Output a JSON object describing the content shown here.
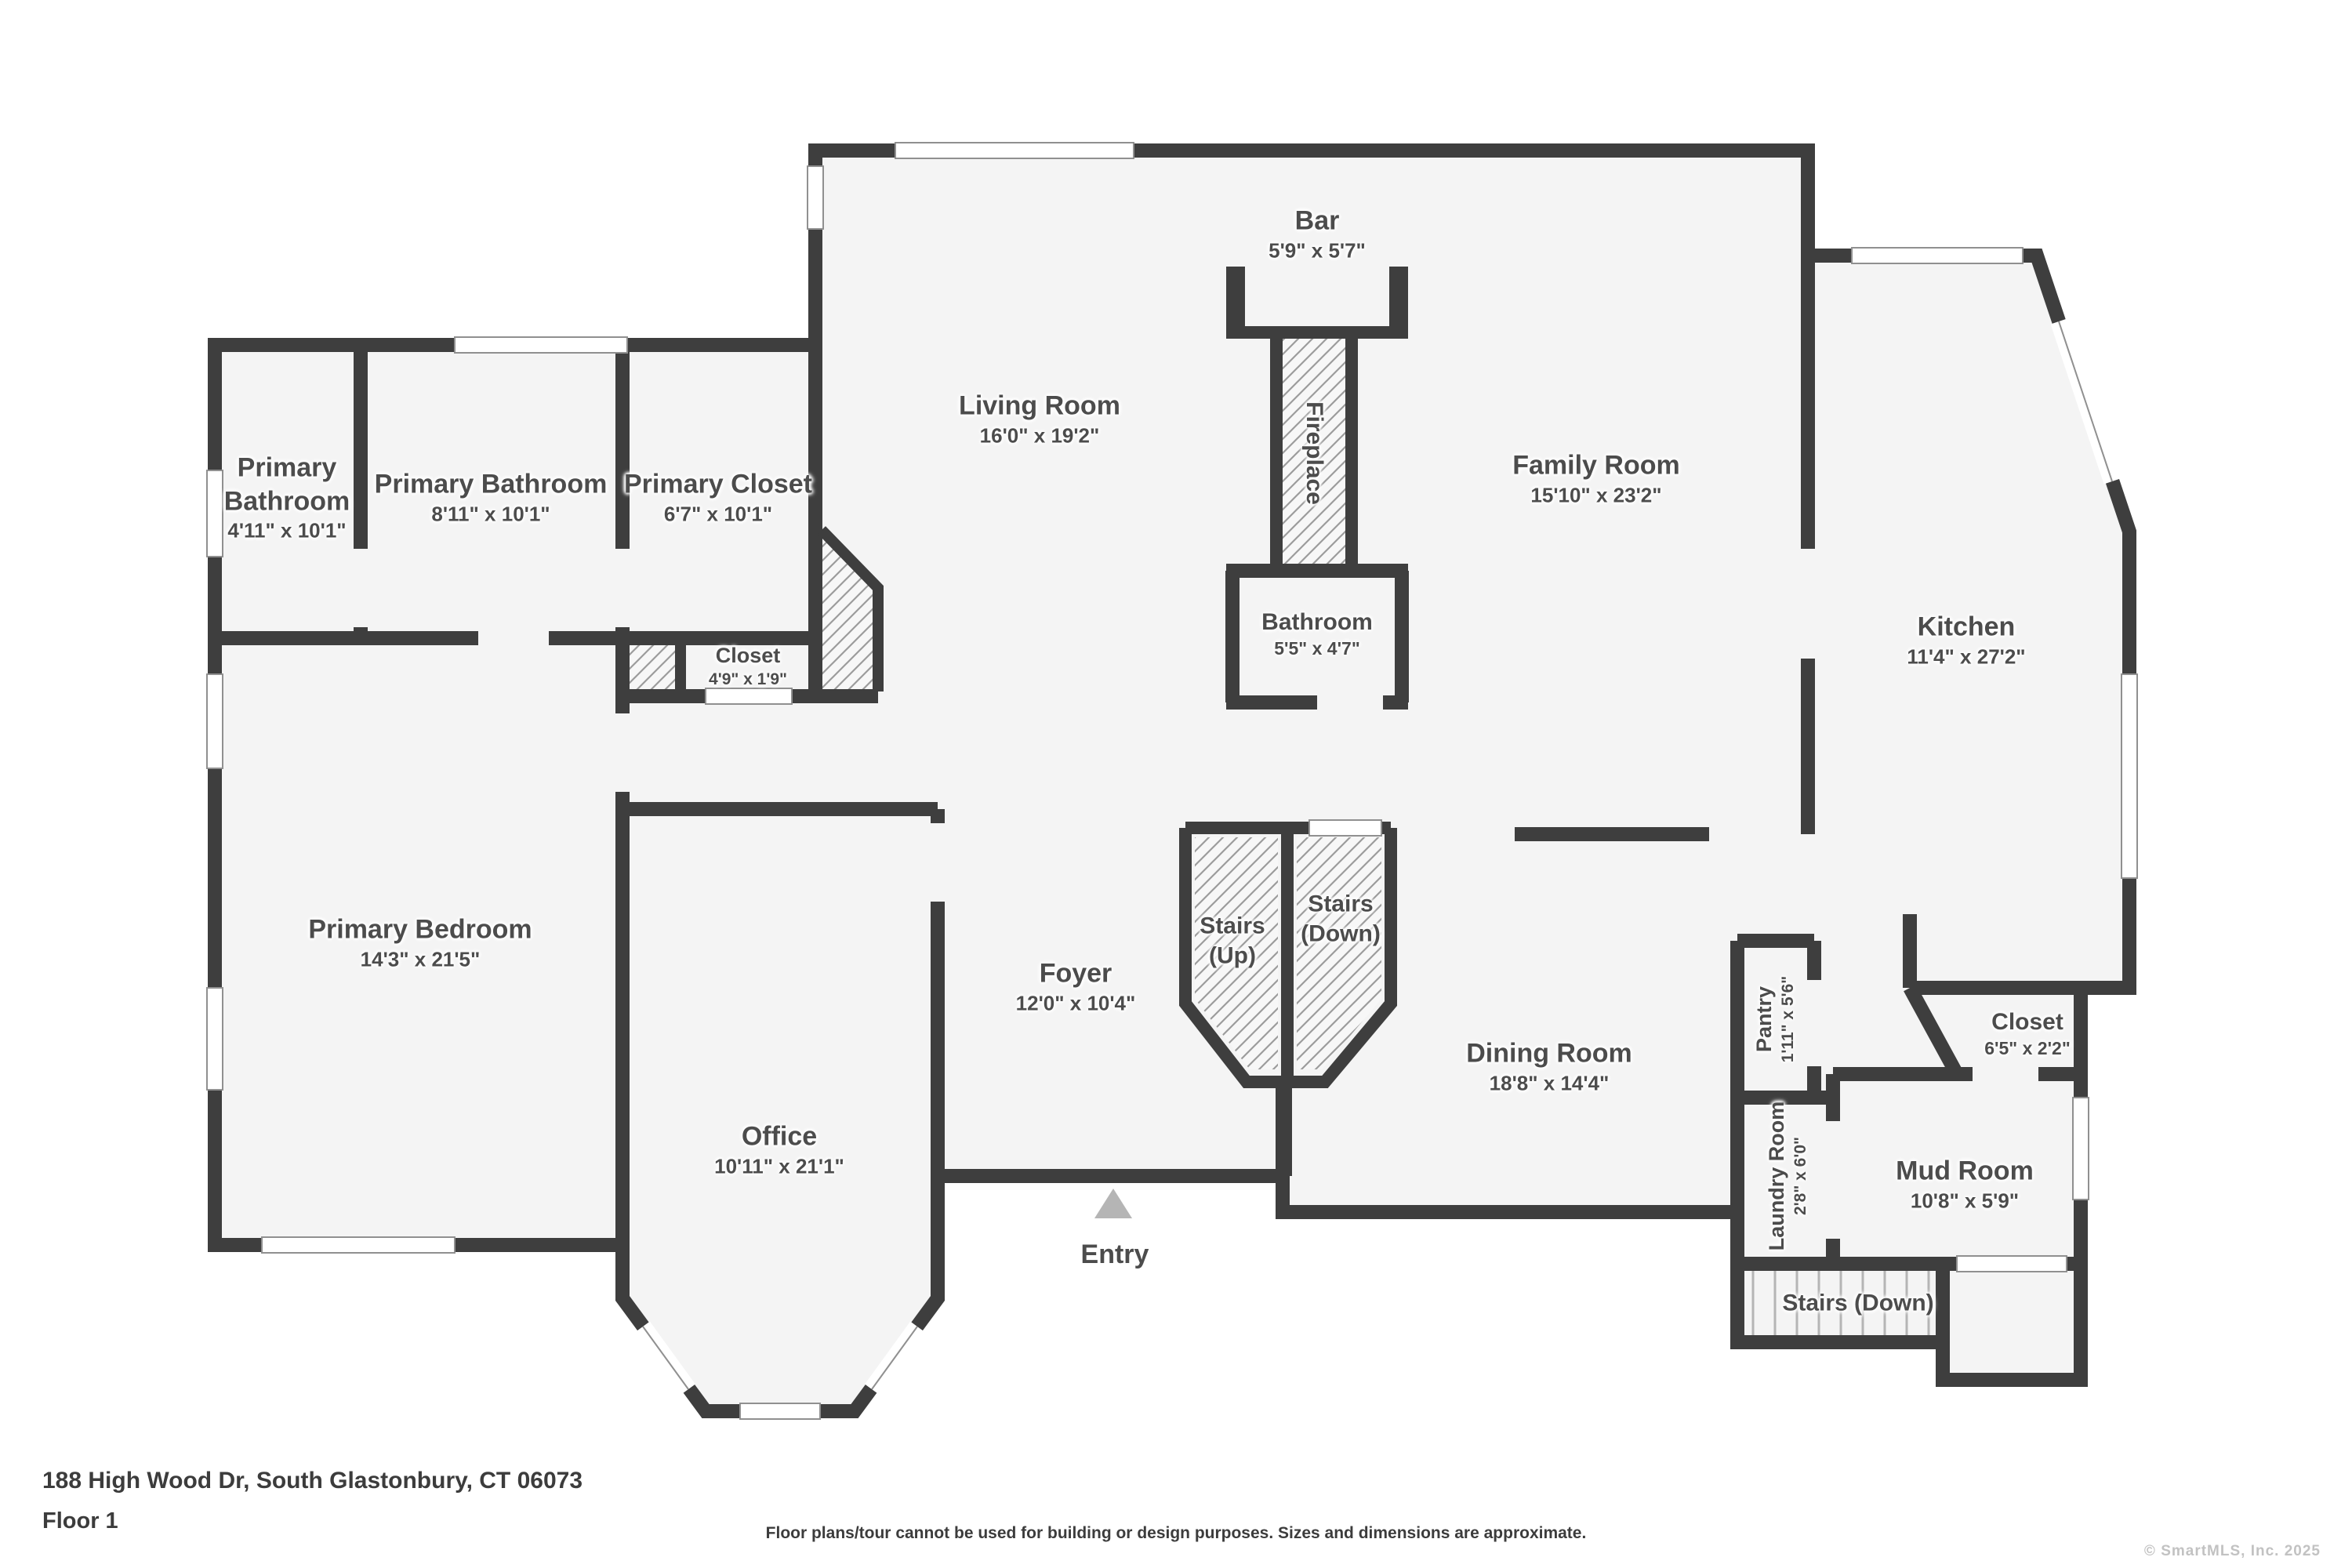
{
  "meta": {
    "address": "188 High Wood Dr, South Glastonbury, CT 06073",
    "floor_label": "Floor 1",
    "disclaimer": "Floor plans/tour cannot be used for building or design purposes. Sizes and dimensions are approximate.",
    "watermark": "© SmartMLS, Inc.  2025"
  },
  "entry": {
    "label": "Entry"
  },
  "colors": {
    "wall": "#3e3e3e",
    "floor": "#f4f4f4",
    "hatch_line": "#9c9c9c",
    "label_text": "#4c4c4c",
    "window_outline": "#909090",
    "entry_arrow": "#b5b5b5",
    "stair_tread": "#b5b5b5",
    "watermark_text": "#c2c2c2"
  },
  "rooms": {
    "bar": {
      "name": "Bar",
      "dims": "5'9\" x 5'7\""
    },
    "living": {
      "name": "Living Room",
      "dims": "16'0\" x 19'2\""
    },
    "fireplace": {
      "name": "Fireplace",
      "dims": ""
    },
    "family": {
      "name": "Family Room",
      "dims": "15'10\" x 23'2\""
    },
    "kitchen": {
      "name": "Kitchen",
      "dims": "11'4\" x 27'2\""
    },
    "bathroom": {
      "name": "Bathroom",
      "dims": "5'5\" x 4'7\""
    },
    "primary_bathroom_small": {
      "name": "Primary Bathroom",
      "dims": "4'11\" x 10'1\""
    },
    "primary_bathroom": {
      "name": "Primary Bathroom",
      "dims": "8'11\" x 10'1\""
    },
    "primary_closet": {
      "name": "Primary Closet",
      "dims": "6'7\" x 10'1\""
    },
    "closet_small": {
      "name": "Closet",
      "dims": "4'9\" x 1'9\""
    },
    "primary_bedroom": {
      "name": "Primary Bedroom",
      "dims": "14'3\" x 21'5\""
    },
    "office": {
      "name": "Office",
      "dims": "10'11\" x 21'1\""
    },
    "foyer": {
      "name": "Foyer",
      "dims": "12'0\" x 10'4\""
    },
    "stairs_up": {
      "name": "Stairs",
      "qualifier": "(Up)"
    },
    "stairs_down": {
      "name": "Stairs",
      "qualifier": "(Down)"
    },
    "dining": {
      "name": "Dining Room",
      "dims": "18'8\" x 14'4\""
    },
    "pantry": {
      "name": "Pantry",
      "dims": "1'11\" x 5'6\""
    },
    "laundry": {
      "name": "Laundry Room",
      "dims": "2'8\" x 6'0\""
    },
    "closet_hall": {
      "name": "Closet",
      "dims": "6'5\" x 2'2\""
    },
    "mud_room": {
      "name": "Mud Room",
      "dims": "10'8\" x 5'9\""
    },
    "stairs_down_lower": {
      "name": "Stairs (Down)",
      "dims": ""
    }
  }
}
